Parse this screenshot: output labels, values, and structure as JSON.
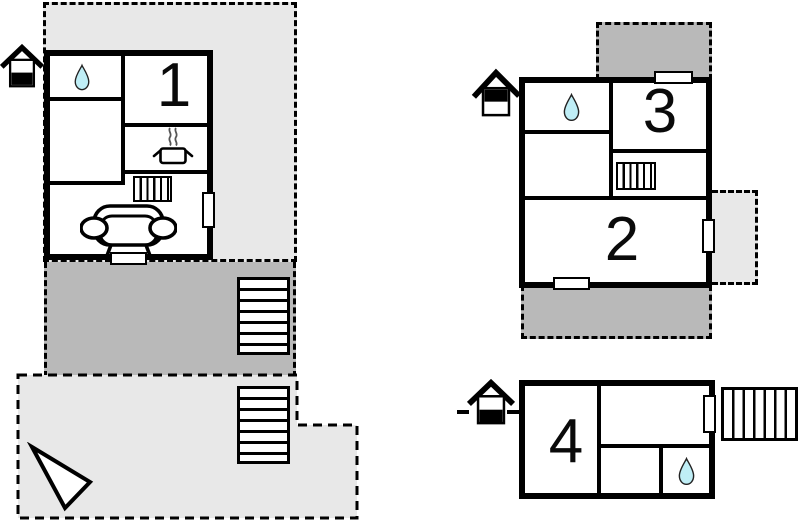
{
  "canvas": {
    "width": 800,
    "height": 524,
    "background": "#ffffff",
    "type": "vacation-home-floor-plan"
  },
  "colors": {
    "wall": "#000000",
    "terrace_light": "#e8e8e8",
    "terrace_dark": "#b9b9b9",
    "water_drop_fill": "#bfeef6",
    "door_fill": "#ffffff",
    "steam": "#555555",
    "number_color": "#0a0a0a"
  },
  "rooms": {
    "r1": "1",
    "r2": "2",
    "r3": "3",
    "r4": "4"
  },
  "icons": {
    "water_drop": "teardrop (water / bathroom)",
    "stove": "cooking pot with steam (kitchen)",
    "radiator": "hatched small box (heating)",
    "sofa": "sofa with armrests (living room)",
    "stairs": "hatched box (staircase)",
    "entrance": "house glyph (entrance marker)",
    "north_arrow": "triangle pointer",
    "door": "white rectangle opening in wall"
  },
  "legend": {
    "dashed_outline": "terrace / outdoor area",
    "solid_outline": "building walls"
  }
}
